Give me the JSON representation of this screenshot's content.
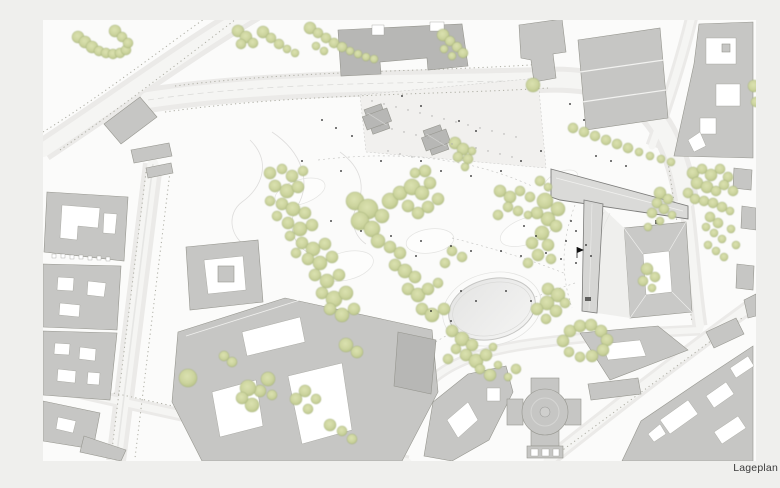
{
  "meta": {
    "caption": "Lageplan"
  },
  "palette": {
    "bg_outer": "#efefed",
    "bg_map": "#fbfbfa",
    "road": "#ebeae8",
    "lane": "#f5f5f3",
    "building": "#c6c6c4",
    "building_dark": "#b7b7b5",
    "building_outline": "#96968f",
    "main_building": "#dadad8",
    "courtyard": "#ffffff",
    "tree_fill": "#ccd49e",
    "tree_edge": "#9fae74",
    "treeline": "#adada3",
    "pond": "#e9e9e8",
    "dot": "#1c1c1c",
    "caption": "#3a3a3a"
  },
  "map": {
    "trees": [
      [
        78,
        37,
        6
      ],
      [
        85,
        42,
        6
      ],
      [
        92,
        47,
        6
      ],
      [
        99,
        51,
        5
      ],
      [
        106,
        53,
        5
      ],
      [
        113,
        54,
        5
      ],
      [
        120,
        53,
        5
      ],
      [
        126,
        50,
        5
      ],
      [
        115,
        31,
        6
      ],
      [
        122,
        37,
        5
      ],
      [
        128,
        43,
        5
      ],
      [
        238,
        31,
        6
      ],
      [
        246,
        37,
        6
      ],
      [
        253,
        43,
        5
      ],
      [
        241,
        44,
        5
      ],
      [
        263,
        32,
        6
      ],
      [
        271,
        38,
        5
      ],
      [
        279,
        44,
        5
      ],
      [
        287,
        49,
        4
      ],
      [
        295,
        53,
        4
      ],
      [
        310,
        28,
        6
      ],
      [
        318,
        33,
        5
      ],
      [
        326,
        38,
        5
      ],
      [
        334,
        43,
        5
      ],
      [
        342,
        47,
        5
      ],
      [
        350,
        51,
        4
      ],
      [
        358,
        54,
        4
      ],
      [
        366,
        57,
        4
      ],
      [
        374,
        59,
        4
      ],
      [
        316,
        46,
        4
      ],
      [
        324,
        51,
        4
      ],
      [
        443,
        35,
        6
      ],
      [
        450,
        41,
        5
      ],
      [
        457,
        47,
        5
      ],
      [
        463,
        53,
        5
      ],
      [
        452,
        56,
        4
      ],
      [
        444,
        49,
        4
      ],
      [
        533,
        85,
        7
      ],
      [
        754,
        86,
        6
      ],
      [
        762,
        94,
        5
      ],
      [
        756,
        102,
        5
      ],
      [
        573,
        128,
        5
      ],
      [
        584,
        132,
        5
      ],
      [
        595,
        136,
        5
      ],
      [
        606,
        140,
        5
      ],
      [
        617,
        144,
        5
      ],
      [
        628,
        148,
        5
      ],
      [
        639,
        152,
        4
      ],
      [
        650,
        156,
        4
      ],
      [
        661,
        159,
        4
      ],
      [
        671,
        162,
        4
      ],
      [
        455,
        143,
        6
      ],
      [
        463,
        149,
        6
      ],
      [
        458,
        157,
        5
      ],
      [
        468,
        159,
        5
      ],
      [
        465,
        167,
        4
      ],
      [
        472,
        151,
        4
      ],
      [
        693,
        173,
        6
      ],
      [
        702,
        169,
        5
      ],
      [
        711,
        175,
        6
      ],
      [
        720,
        169,
        5
      ],
      [
        728,
        177,
        5
      ],
      [
        697,
        183,
        6
      ],
      [
        707,
        187,
        6
      ],
      [
        716,
        191,
        5
      ],
      [
        724,
        185,
        5
      ],
      [
        733,
        191,
        5
      ],
      [
        688,
        193,
        5
      ],
      [
        695,
        199,
        5
      ],
      [
        704,
        201,
        5
      ],
      [
        713,
        203,
        5
      ],
      [
        722,
        207,
        5
      ],
      [
        730,
        211,
        4
      ],
      [
        660,
        193,
        6
      ],
      [
        668,
        199,
        5
      ],
      [
        657,
        203,
        5
      ],
      [
        664,
        209,
        5
      ],
      [
        672,
        215,
        4
      ],
      [
        652,
        213,
        5
      ],
      [
        660,
        221,
        4
      ],
      [
        648,
        227,
        4
      ],
      [
        710,
        217,
        5
      ],
      [
        718,
        223,
        5
      ],
      [
        706,
        227,
        4
      ],
      [
        714,
        233,
        4
      ],
      [
        722,
        239,
        4
      ],
      [
        708,
        245,
        4
      ],
      [
        716,
        251,
        4
      ],
      [
        724,
        257,
        4
      ],
      [
        731,
        229,
        4
      ],
      [
        736,
        245,
        4
      ],
      [
        545,
        201,
        8
      ],
      [
        558,
        209,
        7
      ],
      [
        548,
        219,
        7
      ],
      [
        537,
        213,
        6
      ],
      [
        556,
        226,
        6
      ],
      [
        542,
        233,
        7
      ],
      [
        532,
        243,
        6
      ],
      [
        548,
        245,
        6
      ],
      [
        538,
        255,
        6
      ],
      [
        528,
        263,
        5
      ],
      [
        551,
        259,
        5
      ],
      [
        647,
        269,
        6
      ],
      [
        655,
        277,
        5
      ],
      [
        643,
        281,
        5
      ],
      [
        652,
        288,
        4
      ],
      [
        270,
        173,
        6
      ],
      [
        282,
        169,
        5
      ],
      [
        292,
        176,
        6
      ],
      [
        303,
        171,
        5
      ],
      [
        275,
        186,
        6
      ],
      [
        287,
        191,
        7
      ],
      [
        298,
        187,
        6
      ],
      [
        270,
        201,
        5
      ],
      [
        282,
        204,
        6
      ],
      [
        293,
        209,
        7
      ],
      [
        305,
        213,
        6
      ],
      [
        277,
        216,
        5
      ],
      [
        288,
        223,
        6
      ],
      [
        300,
        229,
        7
      ],
      [
        312,
        225,
        6
      ],
      [
        290,
        236,
        5
      ],
      [
        302,
        243,
        6
      ],
      [
        313,
        249,
        7
      ],
      [
        325,
        244,
        6
      ],
      [
        296,
        253,
        5
      ],
      [
        308,
        259,
        6
      ],
      [
        320,
        263,
        7
      ],
      [
        332,
        257,
        6
      ],
      [
        315,
        275,
        6
      ],
      [
        327,
        281,
        7
      ],
      [
        339,
        275,
        6
      ],
      [
        322,
        293,
        6
      ],
      [
        334,
        299,
        8
      ],
      [
        346,
        293,
        7
      ],
      [
        330,
        309,
        6
      ],
      [
        342,
        315,
        7
      ],
      [
        354,
        309,
        6
      ],
      [
        355,
        201,
        9
      ],
      [
        368,
        209,
        10
      ],
      [
        360,
        221,
        9
      ],
      [
        372,
        229,
        8
      ],
      [
        382,
        216,
        7
      ],
      [
        390,
        201,
        8
      ],
      [
        400,
        193,
        7
      ],
      [
        412,
        187,
        8
      ],
      [
        422,
        193,
        7
      ],
      [
        408,
        206,
        6
      ],
      [
        418,
        213,
        6
      ],
      [
        428,
        207,
        6
      ],
      [
        438,
        199,
        6
      ],
      [
        430,
        183,
        6
      ],
      [
        425,
        171,
        6
      ],
      [
        415,
        173,
        5
      ],
      [
        378,
        241,
        7
      ],
      [
        390,
        247,
        6
      ],
      [
        400,
        253,
        6
      ],
      [
        395,
        265,
        6
      ],
      [
        405,
        271,
        7
      ],
      [
        415,
        277,
        6
      ],
      [
        408,
        289,
        6
      ],
      [
        418,
        295,
        7
      ],
      [
        428,
        289,
        6
      ],
      [
        438,
        283,
        5
      ],
      [
        422,
        309,
        6
      ],
      [
        432,
        315,
        7
      ],
      [
        444,
        309,
        6
      ],
      [
        452,
        251,
        5
      ],
      [
        462,
        257,
        5
      ],
      [
        445,
        263,
        5
      ],
      [
        500,
        191,
        6
      ],
      [
        510,
        197,
        6
      ],
      [
        520,
        191,
        5
      ],
      [
        530,
        197,
        5
      ],
      [
        508,
        207,
        5
      ],
      [
        518,
        211,
        5
      ],
      [
        528,
        215,
        4
      ],
      [
        498,
        215,
        5
      ],
      [
        540,
        181,
        5
      ],
      [
        548,
        187,
        4
      ],
      [
        452,
        331,
        6
      ],
      [
        462,
        339,
        7
      ],
      [
        472,
        345,
        6
      ],
      [
        456,
        349,
        5
      ],
      [
        466,
        355,
        6
      ],
      [
        476,
        361,
        7
      ],
      [
        486,
        355,
        6
      ],
      [
        480,
        369,
        5
      ],
      [
        490,
        375,
        6
      ],
      [
        448,
        359,
        5
      ],
      [
        493,
        347,
        4
      ],
      [
        498,
        365,
        4
      ],
      [
        516,
        369,
        5
      ],
      [
        508,
        377,
        4
      ],
      [
        548,
        289,
        6
      ],
      [
        558,
        295,
        7
      ],
      [
        547,
        303,
        7
      ],
      [
        537,
        309,
        6
      ],
      [
        556,
        311,
        6
      ],
      [
        546,
        319,
        5
      ],
      [
        565,
        303,
        5
      ],
      [
        563,
        341,
        6
      ],
      [
        570,
        331,
        6
      ],
      [
        580,
        326,
        6
      ],
      [
        591,
        325,
        6
      ],
      [
        601,
        331,
        6
      ],
      [
        607,
        340,
        6
      ],
      [
        603,
        350,
        6
      ],
      [
        592,
        356,
        6
      ],
      [
        580,
        357,
        5
      ],
      [
        569,
        352,
        5
      ],
      [
        346,
        345,
        7
      ],
      [
        357,
        352,
        6
      ],
      [
        305,
        391,
        6
      ],
      [
        296,
        399,
        6
      ],
      [
        316,
        399,
        5
      ],
      [
        308,
        409,
        5
      ],
      [
        330,
        425,
        6
      ],
      [
        342,
        431,
        5
      ],
      [
        352,
        439,
        5
      ],
      [
        268,
        379,
        7
      ],
      [
        260,
        391,
        6
      ],
      [
        272,
        395,
        5
      ],
      [
        232,
        362,
        5
      ],
      [
        224,
        356,
        5
      ],
      [
        188,
        378,
        9
      ],
      [
        248,
        388,
        8
      ],
      [
        252,
        405,
        7
      ],
      [
        242,
        398,
        6
      ]
    ],
    "people_dots": [
      [
        322,
        120
      ],
      [
        336,
        128
      ],
      [
        352,
        136
      ],
      [
        402,
        96
      ],
      [
        421,
        106
      ],
      [
        459,
        121
      ],
      [
        476,
        131
      ],
      [
        302,
        161
      ],
      [
        341,
        171
      ],
      [
        381,
        161
      ],
      [
        421,
        161
      ],
      [
        441,
        171
      ],
      [
        471,
        176
      ],
      [
        501,
        171
      ],
      [
        521,
        161
      ],
      [
        541,
        151
      ],
      [
        331,
        221
      ],
      [
        361,
        231
      ],
      [
        391,
        236
      ],
      [
        421,
        241
      ],
      [
        451,
        246
      ],
      [
        471,
        251
      ],
      [
        501,
        251
      ],
      [
        521,
        256
      ],
      [
        546,
        253
      ],
      [
        561,
        259
      ],
      [
        576,
        263
      ],
      [
        591,
        256
      ],
      [
        461,
        291
      ],
      [
        476,
        301
      ],
      [
        506,
        291
      ],
      [
        531,
        301
      ],
      [
        431,
        311
      ],
      [
        451,
        321
      ],
      [
        416,
        256
      ],
      [
        576,
        231
      ],
      [
        566,
        241
      ],
      [
        586,
        245
      ],
      [
        571,
        221
      ],
      [
        524,
        226
      ],
      [
        536,
        236
      ],
      [
        596,
        156
      ],
      [
        611,
        161
      ],
      [
        626,
        166
      ],
      [
        584,
        120
      ],
      [
        570,
        104
      ]
    ],
    "plaza_dots": [
      [
        372,
        101
      ],
      [
        384,
        104
      ],
      [
        396,
        107
      ],
      [
        408,
        110
      ],
      [
        420,
        113
      ],
      [
        432,
        116
      ],
      [
        444,
        119
      ],
      [
        456,
        122
      ],
      [
        380,
        126
      ],
      [
        392,
        129
      ],
      [
        404,
        132
      ],
      [
        416,
        135
      ],
      [
        428,
        138
      ],
      [
        440,
        141
      ],
      [
        452,
        144
      ],
      [
        388,
        151
      ],
      [
        400,
        154
      ],
      [
        412,
        157
      ],
      [
        468,
        125
      ],
      [
        480,
        128
      ],
      [
        492,
        131
      ],
      [
        504,
        134
      ],
      [
        516,
        137
      ],
      [
        476,
        148
      ],
      [
        488,
        151
      ],
      [
        500,
        154
      ],
      [
        512,
        157
      ]
    ],
    "flag_marker": [
      577,
      247
    ]
  }
}
